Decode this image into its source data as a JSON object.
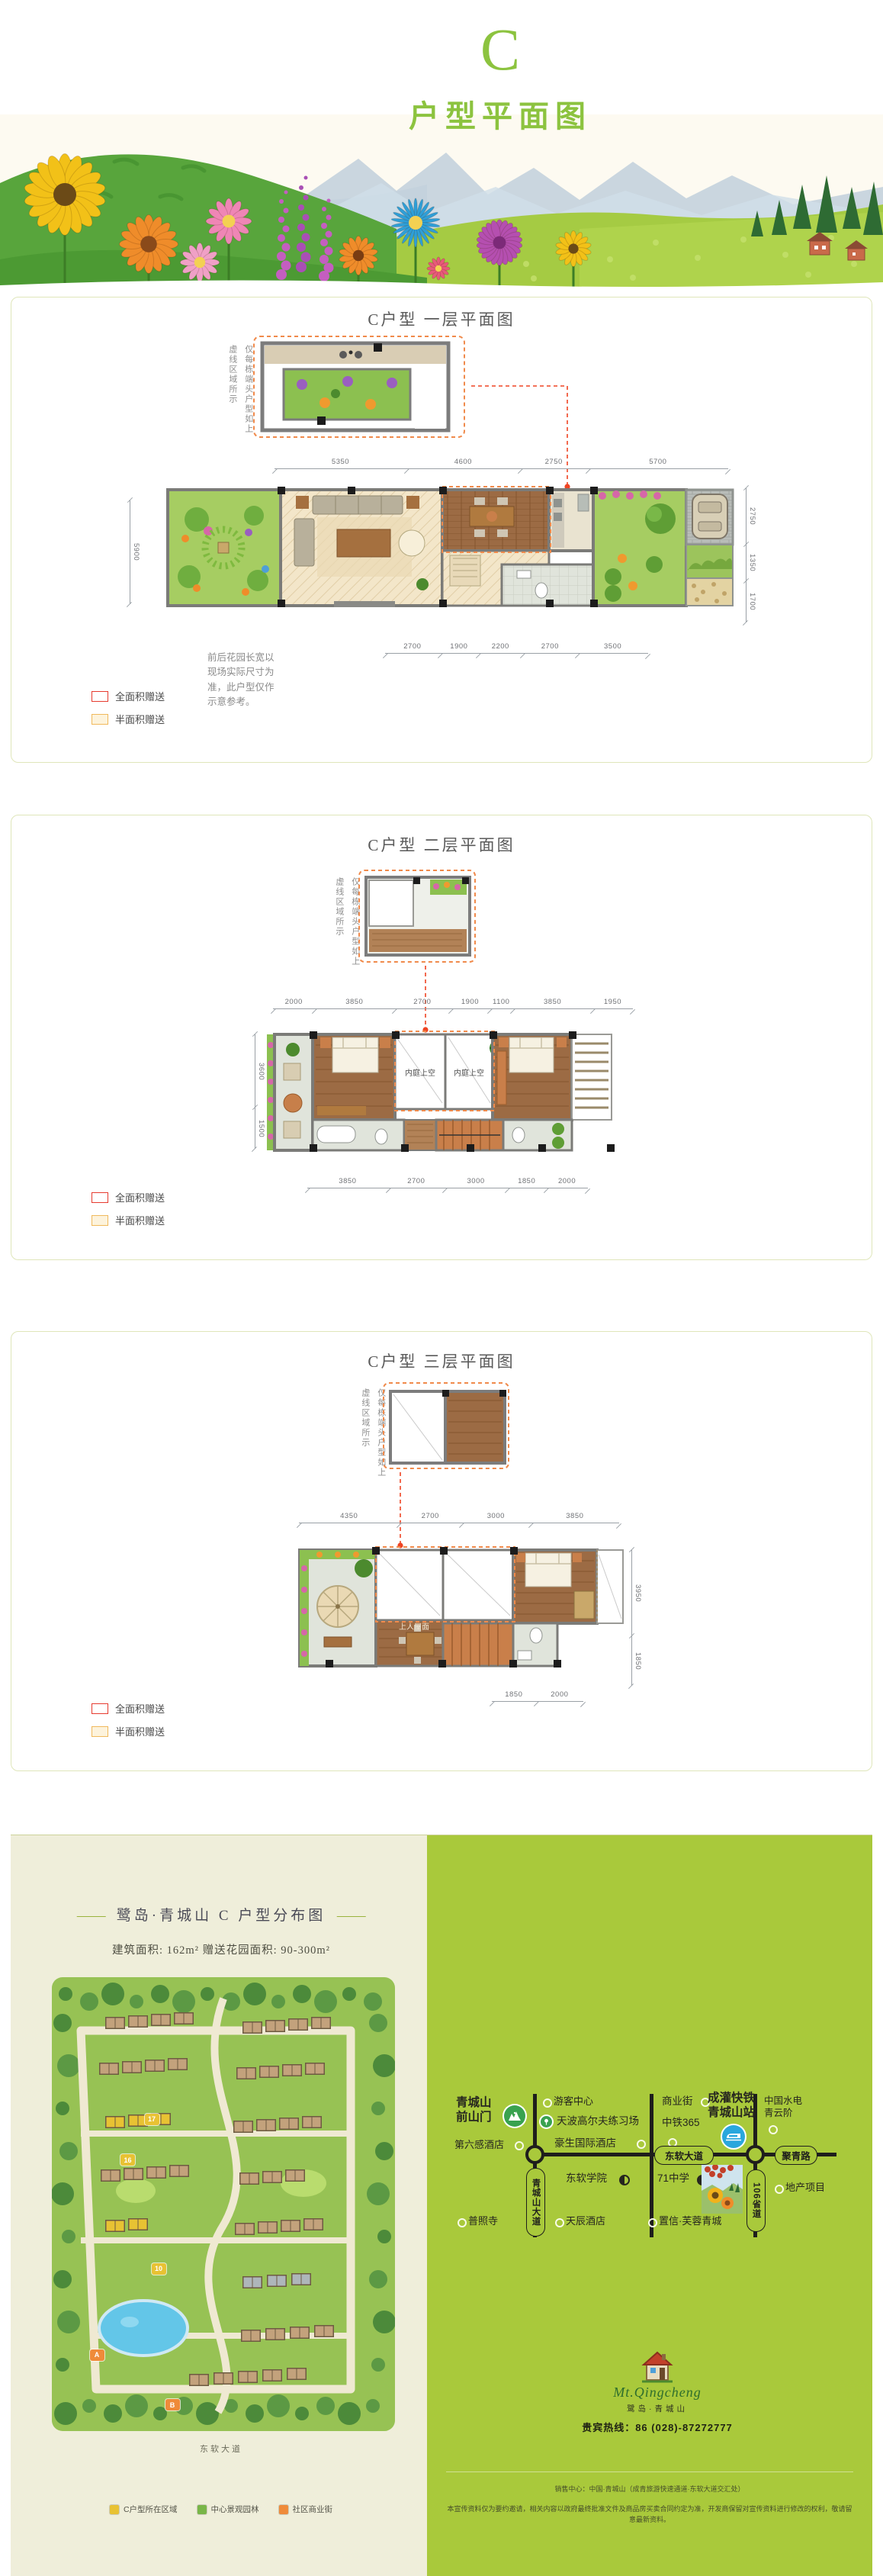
{
  "header": {
    "letter": "C",
    "title": "户型平面图",
    "accent": "#8cc33f"
  },
  "floor1": {
    "title": "C户型 一层平面图",
    "end_unit_note": "仅每栋端头户型如上\n虚线区域所示",
    "garden_note": "前后花园长宽以\n现场实际尺寸为\n准，此户型仅作\n示意参考。",
    "dims_top": [
      "5350",
      "4600",
      "2750",
      "5700"
    ],
    "dims_bottom": [
      "2700",
      "1900",
      "2200",
      "2700",
      "3500"
    ],
    "dims_right": [
      "2750",
      "1350",
      "1700"
    ],
    "dims_left": [
      "5900"
    ],
    "legend": {
      "full": "全面积赠送",
      "half": "半面积赠送"
    }
  },
  "floor2": {
    "title": "C户型 二层平面图",
    "end_unit_note": "仅每栋端头户型如上\n虚线区域所示",
    "void_label": "内庭上空",
    "dims_top": [
      "2000",
      "3850",
      "2700",
      "1900",
      "1100",
      "3850",
      "1950"
    ],
    "dims_bottom": [
      "3850",
      "2700",
      "3000",
      "1850",
      "2000"
    ],
    "dims_left": [
      "3600",
      "1500"
    ],
    "legend": {
      "full": "全面积赠送",
      "half": "半面积赠送"
    }
  },
  "floor3": {
    "title": "C户型 三层平面图",
    "end_unit_note": "仅每栋端头户型如上\n虚线区域所示",
    "roof_label": "上人屋面",
    "dims_top": [
      "4350",
      "2700",
      "3000",
      "3850"
    ],
    "dims_bottom": [
      "1850",
      "2000"
    ],
    "dims_right": [
      "3950",
      "1850"
    ],
    "legend": {
      "full": "全面积赠送",
      "half": "半面积赠送"
    }
  },
  "distribution": {
    "title": "鹭岛·青城山  C  户型分布图",
    "area_info": "建筑面积:  162m²    赠送花园面积:  90-300m²",
    "road_label": "东软大道",
    "markers": [
      {
        "label": "A",
        "color": "#ef8b3a",
        "x": "11%",
        "y": "82%"
      },
      {
        "label": "B",
        "color": "#ef8b3a",
        "x": "33%",
        "y": "93%"
      },
      {
        "label": "10",
        "color": "#e8c233",
        "x": "29%",
        "y": "63%"
      },
      {
        "label": "16",
        "color": "#e8c233",
        "x": "20%",
        "y": "39%"
      },
      {
        "label": "17",
        "color": "#e8c233",
        "x": "27%",
        "y": "30%"
      }
    ],
    "legend": [
      {
        "color": "#e8c233",
        "label": "C户型所在区域"
      },
      {
        "color": "#79b648",
        "label": "中心景观园林"
      },
      {
        "color": "#ef8b3a",
        "label": "社区商业街"
      }
    ]
  },
  "transit": {
    "gate": "青城山\n前山门",
    "visitor_center": "游客中心",
    "golf": "天波高尔夫练习场",
    "howard_hotel": "豪生国际酒店",
    "sixsense_hotel": "第六感酒店",
    "biz_street": "商业街",
    "zhongtie365": "中铁365",
    "rail_station": "成灌快铁\n青城山站",
    "hydro": "中国水电\n青云阶",
    "road_main": "东软大道",
    "road_juqing": "聚青路",
    "road_qcs": "青城山大道",
    "road_106": "106省道",
    "college": "东软学院",
    "school_71": "71中学",
    "temple": "普照寺",
    "tianchen_hotel": "天辰酒店",
    "zhixin": "置信·芙蓉青城",
    "project": "地产项目"
  },
  "footer": {
    "logo_en": "Mt.Qingcheng",
    "logo_cn": "鹭岛·青城山",
    "hotline": "贵宾热线：86 (028)-87272777",
    "fineprint_1": "销售中心：中国·青城山（成青旅游快速通道·东软大道交汇处）",
    "fineprint_2": "本宣传资料仅为要约邀请，相关内容以政府最终批准文件及商品房买卖合同约定为准，开发商保留对宣传资料进行修改的权利，敬请留意最新资料。"
  }
}
